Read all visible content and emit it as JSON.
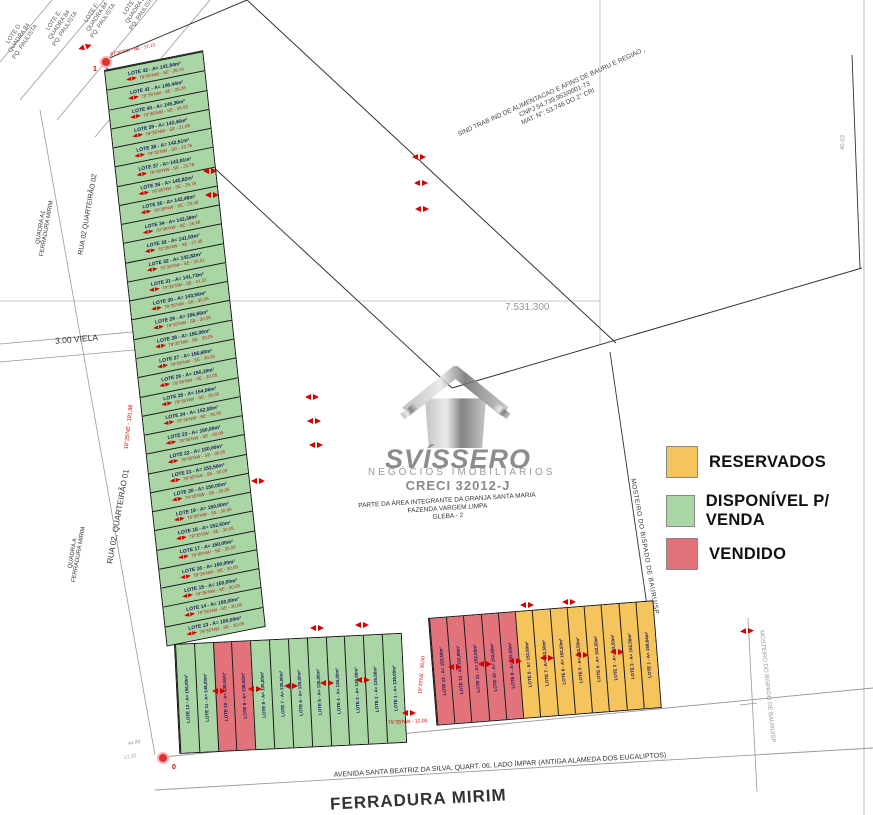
{
  "legend": {
    "items": [
      {
        "key": "reserved",
        "label": "RESERVADOS",
        "color": "#f6c45c"
      },
      {
        "key": "available",
        "label": "DISPONÍVEL P/ VENDA",
        "color": "#a9d6a4"
      },
      {
        "key": "sold",
        "label": "VENDIDO",
        "color": "#e2737b"
      }
    ]
  },
  "watermark": {
    "brand": "SVÍSSERO",
    "subtitle": "NEGÓCIOS IMOBILIÁRIOS",
    "creci": "CRECI 32012-J"
  },
  "area_note": {
    "line1": "PARTE DA ÁREA INTEGRANTE DA GRANJA SANTA MARIA",
    "line2": "FAZENDA VARGEM LIMPA",
    "line3": "GLEBA - 2"
  },
  "sindicato": {
    "line1": "SIND TRAB IND DE ALIMENTACAO E AFINS DE BAURU E REGIAO ,",
    "line2": "CNPJ 54.739.953/0001-73",
    "line3": "MAT. N°: 53.746 DO 2° CRI"
  },
  "streets": {
    "rua02_q01": "RUA 02, QUARTEIRÃO 01",
    "rua02_q02": "RUA 02 QUARTEIRÃO 02",
    "quadra_a1_l1": "QUADRA A1",
    "quadra_a1_l2": "FERRADURA MIRIM",
    "quadra_a_l1": "QUADRA A",
    "quadra_a_l2": "FERRADURA MIRIM",
    "viela": "3.00 VIELA",
    "avenida": "AVENIDA SANTA BEATRIZ DA SILVA, QUART. 06, LADO ÍMPAR (ANTIGA ALAMEDA DOS EUCALIPTOS)",
    "ferradura": "FERRADURA MIRIM",
    "mosteiro1": "MOSTEIRO DO BISPADO DE BAURU/SP",
    "mosteiro2": "MOSTEIRO DO BISPADO DE BAURU/SP"
  },
  "coordinates": {
    "utm_label": "7.531.300",
    "dim_right": "40,03",
    "dim_bl1": "44,89",
    "dim_bl2": "17,32"
  },
  "survey": {
    "point1": "1",
    "point0": "0",
    "bearing_top": "87°30'SW - NE - 17,13",
    "bearing_strip": "19°25'NE - 191,98",
    "bearing_block": "19°25'NE - 36,00",
    "bearing_gap": "79°35'NW - 12,00"
  },
  "neighbors": {
    "items": [
      {
        "line1": "LOTE D",
        "line2": "QUADRA 84",
        "line3": "PQ. PAULISTA"
      },
      {
        "line1": "LOTE E",
        "line2": "QUADRA 84",
        "line3": "PQ. PAULISTA"
      },
      {
        "line1": "LOTE F",
        "line2": "QUADRA 84",
        "line3": "PQ. PAULISTA"
      },
      {
        "line1": "LOTE G",
        "line2": "QUADRA 84",
        "line3": "PQ. PAULISTA"
      }
    ]
  },
  "strips": {
    "vertical": {
      "lots": [
        {
          "num": 42,
          "status": "available",
          "label": "LOTE 42 - A= 141,94m²",
          "bearing": "79°35'NW - SE - 28,16"
        },
        {
          "num": 41,
          "status": "available",
          "label": "LOTE 41 - A= 146,44m²",
          "bearing": "79°35'NW - SE - 28,28"
        },
        {
          "num": 40,
          "status": "available",
          "label": "LOTE 40 - A= 145,36m²",
          "bearing": "79°35'NW - SE - 26,53"
        },
        {
          "num": 39,
          "status": "available",
          "label": "LOTE 39 - A= 142,46m²",
          "bearing": "79°35'NW - SE - 21,68"
        },
        {
          "num": 38,
          "status": "available",
          "label": "LOTE 38 - A= 142,51m²",
          "bearing": "79°35'NW - SE - 23,76"
        },
        {
          "num": 37,
          "status": "available",
          "label": "LOTE 37 - A= 143,91m²",
          "bearing": "79°35'NW - SE - 23,76"
        },
        {
          "num": 36,
          "status": "available",
          "label": "LOTE 36 - A= 145,82m²",
          "bearing": "79°35'NW - SE - 25,76"
        },
        {
          "num": 35,
          "status": "available",
          "label": "LOTE 35 - A= 142,48m²",
          "bearing": "79°35'NW - SE - 23,48"
        },
        {
          "num": 34,
          "status": "available",
          "label": "LOTE 34 - A= 142,36m²",
          "bearing": "79°35'NW - SE - 26,68"
        },
        {
          "num": 33,
          "status": "available",
          "label": "LOTE 33 - A= 141,93m²",
          "bearing": "79°35'NW - SE - 27,46"
        },
        {
          "num": 32,
          "status": "available",
          "label": "LOTE 32 - A= 142,82m²",
          "bearing": "79°35'NW - SE - 26,31"
        },
        {
          "num": 31,
          "status": "available",
          "label": "LOTE 31 - A= 141,73m²",
          "bearing": "79°35'NW - SE - 21,31"
        },
        {
          "num": 30,
          "status": "available",
          "label": "LOTE 30 - A= 143,56m²",
          "bearing": "79°35'NW - SE - 30,05"
        },
        {
          "num": 29,
          "status": "available",
          "label": "LOTE 29 - A= 156,65m²",
          "bearing": "79°35'NW - SE - 30,05"
        },
        {
          "num": 28,
          "status": "available",
          "label": "LOTE 28 - A= 155,06m²",
          "bearing": "79°35'NW - SE - 30,05"
        },
        {
          "num": 27,
          "status": "available",
          "label": "LOTE 27 - A= 156,66m²",
          "bearing": "79°35'NW - SE - 30,05"
        },
        {
          "num": 26,
          "status": "available",
          "label": "LOTE 26 - A= 156,16m²",
          "bearing": "79°35'NW - SE - 30,05"
        },
        {
          "num": 25,
          "status": "available",
          "label": "LOTE 25 - A= 154,56m²",
          "bearing": "79°35'NW - SE - 30,05"
        },
        {
          "num": 24,
          "status": "available",
          "label": "LOTE 24 - A= 152,50m²",
          "bearing": "79°35'NW - SE - 30,05"
        },
        {
          "num": 23,
          "status": "available",
          "label": "LOTE 23 - A= 150,00m²",
          "bearing": "79°35'NW - SE - 30,05"
        },
        {
          "num": 22,
          "status": "available",
          "label": "LOTE 22 - A= 150,00m²",
          "bearing": "79°35'NW - SE - 30,05"
        },
        {
          "num": 21,
          "status": "available",
          "label": "LOTE 21 - A= 152,50m²",
          "bearing": "79°35'NW - SE - 30,05"
        },
        {
          "num": 20,
          "status": "available",
          "label": "LOTE 20 - A= 150,00m²",
          "bearing": "79°35'NW - SE - 30,05"
        },
        {
          "num": 19,
          "status": "available",
          "label": "LOTE 19 - A= 150,00m²",
          "bearing": "79°35'NW - SE - 30,05"
        },
        {
          "num": 18,
          "status": "available",
          "label": "LOTE 18 - A= 152,50m²",
          "bearing": "79°35'NW - SE - 30,05"
        },
        {
          "num": 17,
          "status": "available",
          "label": "LOTE 17 - A= 150,00m²",
          "bearing": "79°35'NW - SE - 30,05"
        },
        {
          "num": 16,
          "status": "available",
          "label": "LOTE 16 - A= 150,00m²",
          "bearing": "79°35'NW - SE - 30,05"
        },
        {
          "num": 15,
          "status": "available",
          "label": "LOTE 15 - A= 150,00m²",
          "bearing": "79°35'NW - SE - 30,05"
        },
        {
          "num": 14,
          "status": "available",
          "label": "LOTE 14 - A= 150,00m²",
          "bearing": "79°35'NW - SE - 30,05"
        },
        {
          "num": 13,
          "status": "available",
          "label": "LOTE 13 - A= 150,00m²",
          "bearing": "79°35'NW - SE - 30,05"
        }
      ]
    },
    "bottom_left": {
      "lots": [
        {
          "num": 12,
          "status": "available",
          "label": "LOTE 12 - A= 156,00m²"
        },
        {
          "num": 11,
          "status": "available",
          "label": "LOTE 11 - A= 148,00m²"
        },
        {
          "num": 10,
          "status": "sold",
          "label": "LOTE 10 - A= 138,50m²"
        },
        {
          "num": 9,
          "status": "sold",
          "label": "LOTE 9 - A= 138,50m²"
        },
        {
          "num": 8,
          "status": "available",
          "label": "LOTE 8 - A= 135,00m²"
        },
        {
          "num": 7,
          "status": "available",
          "label": "LOTE 7 - A= 135,00m²"
        },
        {
          "num": 6,
          "status": "available",
          "label": "LOTE 6 - A= 135,00m²"
        },
        {
          "num": 5,
          "status": "available",
          "label": "LOTE 5 - A= 135,00m²"
        },
        {
          "num": 4,
          "status": "available",
          "label": "LOTE 4 - A= 135,00m²"
        },
        {
          "num": 3,
          "status": "available",
          "label": "LOTE 3 - A= 135,00m²"
        },
        {
          "num": 2,
          "status": "available",
          "label": "LOTE 2 - A= 135,00m²"
        },
        {
          "num": 1,
          "status": "available",
          "label": "LOTE 1 - A= 138,00m²"
        }
      ]
    },
    "bottom_right": {
      "lots": [
        {
          "num": 13,
          "status": "sold",
          "label": "LOTE 13 - A= 152,50m²"
        },
        {
          "num": 12,
          "status": "sold",
          "label": "LOTE 12 - A= 152,50m²"
        },
        {
          "num": 11,
          "status": "sold",
          "label": "LOTE 11 - A= 152,50m²"
        },
        {
          "num": 10,
          "status": "sold",
          "label": "LOTE 10 - A= 152,50m²"
        },
        {
          "num": 9,
          "status": "sold",
          "label": "LOTE 9 - A= 152,50m²"
        },
        {
          "num": 8,
          "status": "reserved",
          "label": "LOTE 8 - A= 152,50m²"
        },
        {
          "num": 7,
          "status": "reserved",
          "label": "LOTE 7 - A= 152,50m²"
        },
        {
          "num": 6,
          "status": "reserved",
          "label": "LOTE 6 - A= 152,50m²"
        },
        {
          "num": 5,
          "status": "reserved",
          "label": "LOTE 5 - A= 152,50m²"
        },
        {
          "num": 4,
          "status": "reserved",
          "label": "LOTE 4 - A= 152,50m²"
        },
        {
          "num": 3,
          "status": "reserved",
          "label": "LOTE 3 - A= 152,50m²"
        },
        {
          "num": 2,
          "status": "reserved",
          "label": "LOTE 2 - A= 152,50m²"
        },
        {
          "num": 1,
          "status": "reserved",
          "label": "LOTE 1 - A= 158,64m²"
        }
      ]
    }
  }
}
